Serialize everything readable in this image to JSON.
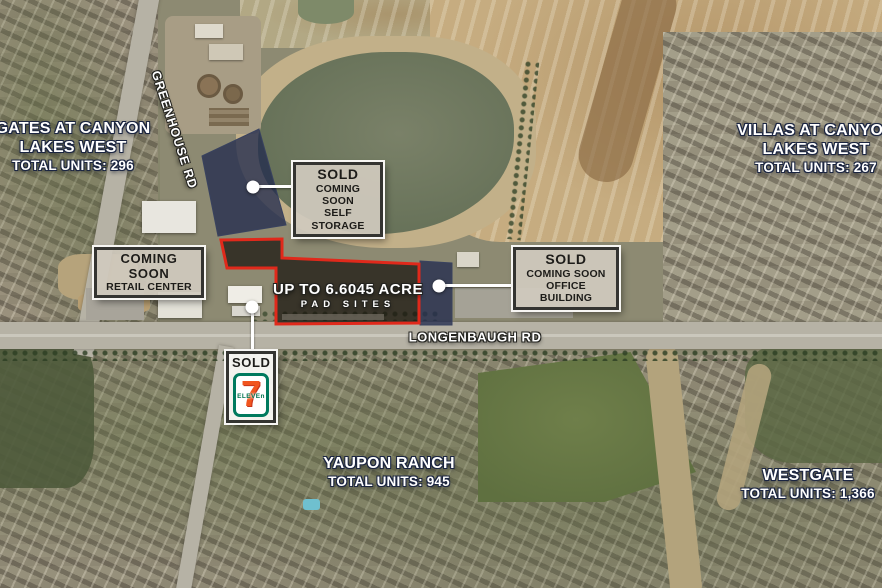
{
  "map": {
    "area_labels": [
      {
        "id": "gates",
        "line1": "GATES AT CANYON",
        "line2": "LAKES WEST",
        "units": "TOTAL UNITS: 296"
      },
      {
        "id": "villas",
        "line1": "VILLAS AT CANYON",
        "line2": "LAKES WEST",
        "units": "TOTAL UNITS: 267"
      },
      {
        "id": "yaupon",
        "line1": "YAUPON RANCH",
        "units": "TOTAL UNITS: 945"
      },
      {
        "id": "westgate",
        "line1": "WESTGATE",
        "units": "TOTAL UNITS: 1,366"
      }
    ],
    "roads": {
      "greenhouse": "GREENHOUSE RD",
      "longenbaugh": "LONGENBAUGH RD"
    },
    "pad_sites": {
      "line1": "UP TO 6.6045 ACRE",
      "line2": "PAD SITES"
    },
    "callouts": {
      "self_storage": {
        "title": "SOLD",
        "sub1": "COMING SOON",
        "sub2": "SELF STORAGE"
      },
      "retail": {
        "title": "COMING SOON",
        "sub1": "RETAIL CENTER"
      },
      "office": {
        "title": "SOLD",
        "sub1": "COMING SOON",
        "sub2": "OFFICE BUILDING"
      },
      "seven_eleven": {
        "title": "SOLD",
        "logo_seven": "7",
        "logo_eleven": "ELEVEn"
      }
    },
    "colors": {
      "parcel_overlay_navy": "#222b4e",
      "pad_outline_red": "#e0291b",
      "callout_background": "#d0cabe",
      "callout_border": "#343431",
      "seven_eleven_green": "#007a5e",
      "seven_eleven_orange": "#f1551e",
      "label_white": "#ffffff"
    }
  }
}
